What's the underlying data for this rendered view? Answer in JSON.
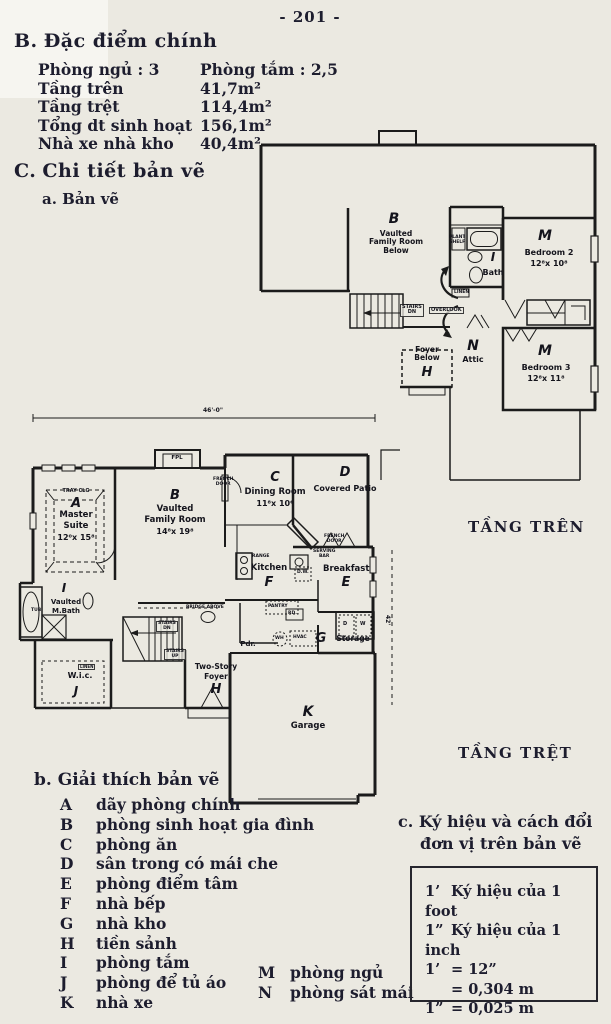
{
  "page": {
    "number": "- 201 -"
  },
  "features": {
    "heading_letter": "B.",
    "heading": "Đặc điểm chính",
    "rows": [
      {
        "label": "Phòng ngủ : 3",
        "value": "Phòng tắm : 2,5"
      },
      {
        "label": "Tầng trên",
        "value": "41,7m²"
      },
      {
        "label": "Tầng trệt",
        "value": "114,4m²"
      },
      {
        "label": "Tổng dt sinh hoạt",
        "value": "156,1m²"
      },
      {
        "label": "Nhà xe nhà kho",
        "value": "40,4m²"
      }
    ]
  },
  "details": {
    "heading_letter": "C.",
    "heading": "Chi tiết bản vẽ",
    "sub_a": "a. Bản vẽ"
  },
  "upper_plan": {
    "title": "TẦNG TRÊN",
    "family_room": {
      "letter": "B",
      "lines": "Vaulted\nFamily Room\nBelow"
    },
    "bath": {
      "letter": "I",
      "name": "Bath"
    },
    "bedroom2": {
      "letter": "M",
      "name": "Bedroom 2",
      "dims": "12⁸x 10⁸"
    },
    "bedroom3": {
      "letter": "M",
      "name": "Bedroom 3",
      "dims": "12⁸x 11⁸"
    },
    "foyer_below": {
      "letter": "H",
      "lines": "Foyer\nBelow"
    },
    "attic": {
      "letter": "N",
      "name": "Attic"
    },
    "annotations": {
      "stairs_dn": "STAIRS\nDN",
      "overlook": "OVERLOOK",
      "plant_shelf": "PLANT\nSHELF",
      "linen": "LINEN"
    }
  },
  "ground_plan": {
    "title": "TẦNG TRỆT",
    "dim_top": "46'-0\"",
    "dim_right": "42'",
    "master": {
      "letter": "A",
      "line1": "Master",
      "line2": "Suite",
      "dims": "12⁰x 15⁸",
      "ceiling": "TRAY CLG"
    },
    "family": {
      "letter": "B",
      "line1": "Vaulted",
      "line2": "Family Room",
      "dims": "14⁸x 19⁸"
    },
    "fireplace": "FPL",
    "dining": {
      "letter": "C",
      "name": "Dining Room",
      "dims": "11⁸x 10⁶"
    },
    "patio": {
      "letter": "D",
      "name": "Covered Patio"
    },
    "breakfast": {
      "letter": "E",
      "name": "Breakfast"
    },
    "kitchen": {
      "letter": "F",
      "name": "Kitchen"
    },
    "storage": {
      "letter": "G",
      "name": "Storage"
    },
    "foyer": {
      "letter": "H",
      "line1": "Two-Story",
      "line2": "Foyer"
    },
    "mbath": {
      "letter": "I",
      "line1": "Vaulted",
      "line2": "M.Bath",
      "tub": "TUB"
    },
    "wic": {
      "letter": "J",
      "name": "W.i.c.",
      "linen": "LINEN"
    },
    "garage": {
      "letter": "K",
      "name": "Garage"
    },
    "annotations": {
      "french_door_left": "FRENCH\nDOOR",
      "french_door_patio": "FRENCH\nDOOR",
      "serving_bar": "SERVING\nBAR",
      "range": "RANGE",
      "dw": "D.W.",
      "pantry": "PANTRY",
      "rd": "RD.",
      "pdr": "Pdr.",
      "bridge": "BRIDGE ABOVE",
      "stairs_dn": "STAIRS\nDN",
      "stairs_up": "STAIRS\nUP",
      "wh": "WH",
      "hvac": "HVAC",
      "washer": "W",
      "dryer": "D"
    }
  },
  "legend": {
    "heading_letter": "b.",
    "heading": "Giải thích bản vẽ",
    "items": [
      {
        "key": "A",
        "text": "dãy phòng chính"
      },
      {
        "key": "B",
        "text": "phòng sinh hoạt gia đình"
      },
      {
        "key": "C",
        "text": "phòng ăn"
      },
      {
        "key": "D",
        "text": "sân trong có mái che"
      },
      {
        "key": "E",
        "text": "phòng điểm tâm"
      },
      {
        "key": "F",
        "text": "nhà bếp"
      },
      {
        "key": "G",
        "text": "nhà kho"
      },
      {
        "key": "H",
        "text": "tiền sảnh"
      },
      {
        "key": "I",
        "text": "phòng tắm"
      },
      {
        "key": "J",
        "text": "phòng để tủ áo"
      },
      {
        "key": "K",
        "text": "nhà xe"
      }
    ],
    "items_right": [
      {
        "key": "M",
        "text": "phòng ngủ"
      },
      {
        "key": "N",
        "text": "phòng sát mái"
      }
    ]
  },
  "units": {
    "heading_letter": "c.",
    "heading_line1": "Ký hiệu và cách đổi",
    "heading_line2": "đơn vị trên bản vẽ",
    "lines": [
      {
        "sym": "1’",
        "rest": "Ký hiệu của 1 foot"
      },
      {
        "sym": "1”",
        "rest": "Ký hiệu của 1 inch"
      },
      {
        "sym": "1’",
        "rest": "= 12”"
      },
      {
        "sym": "",
        "rest": "= 0,304 m"
      },
      {
        "sym": "1”",
        "rest": "= 0,025 m"
      }
    ]
  }
}
